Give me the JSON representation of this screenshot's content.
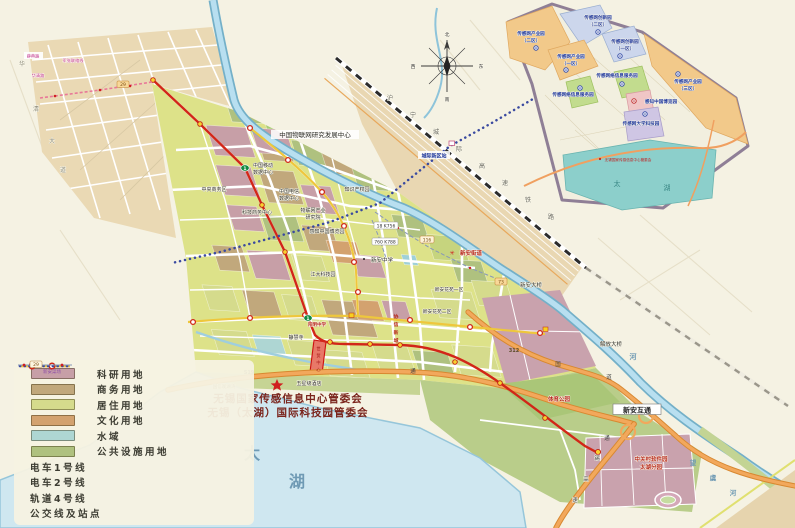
{
  "legend": {
    "items": [
      {
        "label": "科研用地",
        "type": "swatch",
        "color": "#c79fa7"
      },
      {
        "label": "商务用地",
        "type": "swatch",
        "color": "#c1a87c"
      },
      {
        "label": "居住用地",
        "type": "swatch",
        "color": "#d5db8c"
      },
      {
        "label": "文化用地",
        "type": "swatch",
        "color": "#d3a26f"
      },
      {
        "label": "水域",
        "type": "swatch",
        "color": "#aed6d3"
      },
      {
        "label": "公共设施用地",
        "type": "swatch",
        "color": "#afc17f"
      },
      {
        "label": "电车1号线",
        "type": "tram1",
        "color": "#d03020"
      },
      {
        "label": "电车2号线",
        "type": "tram2",
        "color": "#eec73c"
      },
      {
        "label": "轨道4号线",
        "type": "rail4",
        "color": "#3a4aa0"
      },
      {
        "label": "公交线及站点",
        "type": "bus",
        "color": "#8898b8"
      }
    ],
    "bus_badge": "29",
    "bus_stop_label": "新安菜场"
  },
  "hq": {
    "line1": "无锡国家传感信息中心管委会",
    "line2": "无锡（太湖）国际科技园管委会"
  },
  "compass": {
    "n": "北",
    "s": "南",
    "e": "东",
    "w": "西"
  },
  "railway": {
    "name_chars": [
      "沪",
      "宁",
      "城",
      "际",
      "高",
      "速",
      "铁",
      "路"
    ]
  },
  "roads": {
    "s19": "S19",
    "g312": "312",
    "guo": "国",
    "dao": "道",
    "tong": "通",
    "tong2": "通",
    "sw": [
      "锡",
      "高",
      "速"
    ],
    "huaqing": [
      "华",
      "清",
      "大",
      "道"
    ]
  },
  "water": {
    "lake": [
      "太",
      "湖"
    ],
    "he": "河",
    "wangyu": [
      "望",
      "虞",
      "河"
    ]
  },
  "badges": {
    "b29": "29",
    "b73": "73",
    "b116": "116",
    "b18": "18 K756",
    "b760": "760 K788",
    "tram1": "1"
  },
  "labels": {
    "iot_center": "中国物联网研究发展中心",
    "mobile_dc_1": "中国移动",
    "mobile_dc_2": "数据中心",
    "telecom_dc_1": "中国电信",
    "telecom_dc_2": "数据中心",
    "cbd": "中央商务区",
    "tech_biz": "科技商务中心",
    "ip_park": "知识产权园",
    "iot_inst_1": "物联网产业",
    "iot_inst_2": "研究院",
    "expo": "感知中国博览园",
    "jiangda": "江大科技园",
    "xinan_school": "新安中学",
    "huayuan_1": "新安花苑一区",
    "huayuan_2": "新安花苑二区",
    "jinghui": "静慧寺",
    "hotel": "五星级酒店",
    "guoxin": "国信观湖湾",
    "xinan_bridge": "新安大桥",
    "jiefang_bridge": "解放大桥",
    "xinan_ic": "新安互通",
    "sports_park": "体育公园",
    "zgc_1": "中关村软件园",
    "zgc_2": "太湖分园",
    "yangming": "阳明中学",
    "xiexin": [
      "协",
      "信",
      "新",
      "城"
    ],
    "red_block": [
      "世",
      "贸",
      "中",
      "心"
    ],
    "station_chengji": "城际新区站",
    "pink_label_1": "薛典路",
    "pink_label_2": "军张联络线",
    "pink_label_3": "华清路",
    "street_office": "新安街道"
  },
  "inset": {
    "areas": [
      {
        "name": "传感网产业园",
        "sub": "（二区）"
      },
      {
        "name": "传感网创新园",
        "sub": "（二区）"
      },
      {
        "name": "传感网创新园",
        "sub": "（一区）"
      },
      {
        "name": "传感网产业园",
        "sub": "（一区）"
      },
      {
        "name": "传感网产业园",
        "sub": "（三区）"
      },
      {
        "name": "传感网络信息服务园",
        "sub": ""
      },
      {
        "name": "传感网络信息服务园",
        "sub": ""
      },
      {
        "name": "感知中国博览园",
        "sub": ""
      },
      {
        "name": "传感网大学科技园",
        "sub": ""
      }
    ],
    "lake": [
      "太",
      "湖"
    ],
    "hq_note": "无锡国家传感信息中心管委会"
  }
}
